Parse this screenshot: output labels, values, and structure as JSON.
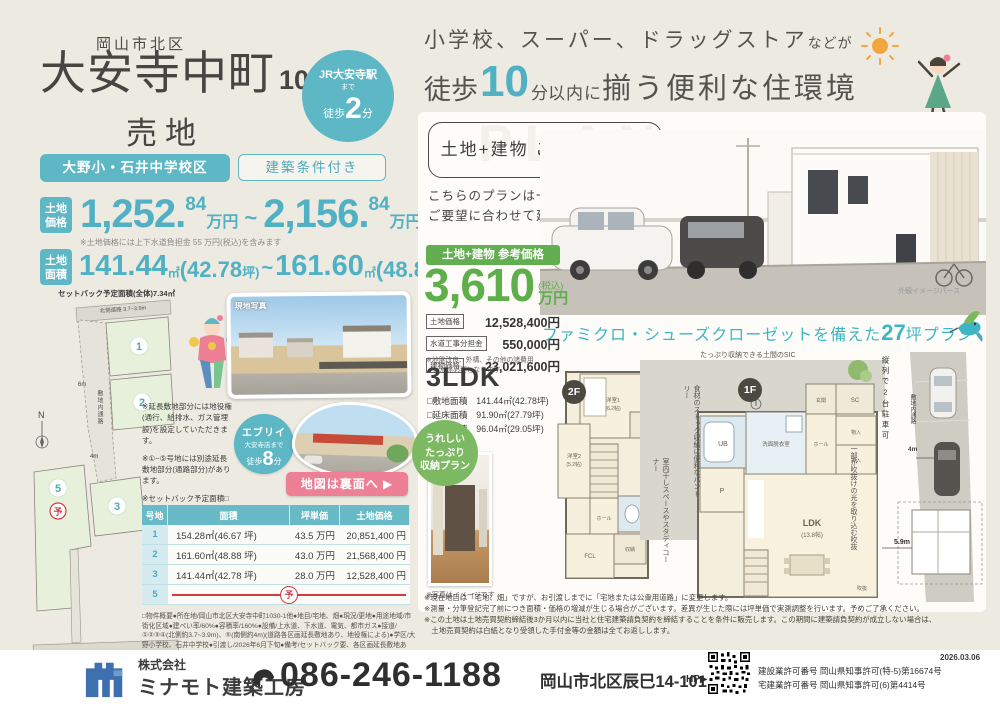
{
  "colors": {
    "teal": "#54b3c4",
    "green": "#5fae4c",
    "pink": "#ee8096",
    "red": "#d33b44",
    "blue": "#3e6fae"
  },
  "top": {
    "district": "岡山市北区",
    "title": "大安寺中町",
    "lot_no": "1030",
    "type": "売地",
    "station": {
      "l1": "JR大安寺駅",
      "l2": "まで",
      "walk": "徒歩",
      "min": "2",
      "unit": "分"
    },
    "badge_school": "大野小・石井中学校区",
    "badge_condition": "建築条件付き"
  },
  "price": {
    "label_l1": "土地",
    "label_l2": "価格",
    "n1": "1,252.",
    "d1": "84",
    "u1": "万円",
    "sep": "~",
    "n2": "2,156.",
    "d2": "84",
    "u2": "万円",
    "note": "※土地価格には上下水道負担金 55 万円(税込)を含みます",
    "area_label_l1": "土地",
    "area_label_l2": "面積",
    "a1": "141.44",
    "au1": "㎡",
    "ab1": "(42.78",
    "at1": "坪)",
    "asep": "~",
    "a2": "161.60",
    "au2": "㎡",
    "ab2": "(48.88",
    "at2": "坪)"
  },
  "siteplan": {
    "setback": "セットバック予定面積(全体)7.34㎡",
    "north_road": "北側道路 3.7~3.9m",
    "south_road": "南側道路 4.0m",
    "passage": "敷地内通路",
    "w6": "6m",
    "w4": "4m",
    "north": "N",
    "lot1": "1",
    "lot2": "2",
    "lot3": "3",
    "lot5": "5",
    "reserved": "予"
  },
  "site_photo_label": "現地写真",
  "notes": [
    "※延長敷地部分には地役権(通行、給排水、ガス管埋設)を設定していただきます。",
    "※①~⑤号地には別途延長敷地部分(通路部分)があります。",
    "※セットバック予定面積□は各号地の面積に含まれていません。"
  ],
  "every": {
    "name": "エブリイ",
    "sub": "大安寺店まで",
    "walk": "徒歩",
    "min": "8",
    "unit": "分"
  },
  "map_banner": "地図は裏面へ ▶",
  "lots_table": {
    "h": [
      "号地",
      "面積",
      "坪単価",
      "土地価格"
    ],
    "rows": [
      {
        "no": "1",
        "area": "154.28㎡(46.67 坪)",
        "tanka": "43.5 万円",
        "price": "20,851,400 円"
      },
      {
        "no": "2",
        "area": "161.60㎡(48.88 坪)",
        "tanka": "43.0 万円",
        "price": "21,568,400 円"
      },
      {
        "no": "3",
        "area": "141.44㎡(42.78 坪)",
        "tanka": "28.0 万円",
        "price": "12,528,400 円"
      },
      {
        "no": "5",
        "reserved": "予"
      }
    ]
  },
  "overview": "□物件概要●所在地/岡山市北区大安寺中町1030-1他●地目/宅地、畑●現況/更地●用途地域/市街化区域●建ぺい率/60%●容積率/160%●設備/上水道、下水道、電気、都市ガス●接道/①②③④(北側約3.7~3.9m)、⑤(南側約4m)(道路各区画延長敷地あり、地役権による)●学区/大野小学校、石井中学校●引渡し/2026年6月下旬●備考/セットバック要、各区画延長敷地あり、宅地造成等工事規制区域●取引態様/売主",
  "headline": {
    "l1a": "小学校、スーパー、ドラッグストア",
    "l1b": "などが",
    "l2a": "徒歩",
    "l2num": "10",
    "l2b": "分",
    "l2c": "以内に",
    "l2d": "揃う便利な住環境"
  },
  "plan": {
    "watermark": "PLAN",
    "box": "土地+建物 ご参考プラン",
    "lot_num": "3",
    "lot_suffix": "号地",
    "desc1": "こちらのプランは一例です。",
    "desc2": "ご要望に合わせて建物プランいたします。",
    "render_caption": "外観イメージパース",
    "price_badge": "土地+建物 参考価格",
    "price": "3,610",
    "tax": "(税込)",
    "unit": "万円",
    "breakdown": [
      {
        "label": "土地価格",
        "value": "12,528,400円"
      },
      {
        "label": "水道工事分担金",
        "value": "550,000円"
      },
      {
        "label": "建物価格",
        "value": "23,021,600円"
      }
    ],
    "bd_note1": "※地盤改良、外構、その他の諸費用",
    "bd_note2": "　が別途必要となります。",
    "tagline_a": "ファミクロ・シューズクローゼットを備えた",
    "tagline_num": "27",
    "tagline_b": "坪プラン"
  },
  "ldk": {
    "title": "3LDK",
    "specs": [
      "□敷地面積　141.44㎡(42.78坪)",
      "□延床面積　91.90㎡(27.79坪)",
      "□施工面積　96.04㎡(29.05坪)"
    ],
    "circle": [
      "うれしい",
      "たっぷり",
      "収納プラン"
    ],
    "photo_caption": "※写真はイメージです",
    "f2": "2F",
    "f1": "1F",
    "ann_sic": "たっぷり収納できる土間のSIC",
    "ann_pantry": "食材のストック収納に便利なパントリー",
    "ann_study": "室内干しスペースやスタディコーナー",
    "ann_void": "一部が吹抜けの光を取り込む吹抜",
    "ann_parking": "縦列で2台駐車可",
    "ann_passage": "敷地内通路",
    "ann_4m": "4m",
    "ann_59m": "5.9m",
    "rooms2f": {
      "r1": "洋室1",
      "r1s": "(6.2帖)",
      "r2": "洋室2",
      "r2s": "(5.2帖)",
      "hall": "ホール",
      "fcl": "FCL",
      "stor": "収納"
    },
    "rooms1f": {
      "ub": "UB",
      "wash": "洗面脱衣室",
      "hall": "ホール",
      "genkan": "玄関",
      "sc": "SC",
      "mono": "物入",
      "oshi": "押入",
      "p": "P",
      "ldk": "LDK",
      "ldks": "(13.8帖)",
      "void": "吹抜"
    }
  },
  "disclaimers": [
    "※現在地目は「宅地、畑」ですが、お引渡しまでに「宅地または公衆用道路」に変更します。",
    "※測量・分筆登記完了前につき面積・価格の増減が生じる場合がございます。差異が生じた際には坪単価で実測調整を行います。予めご了承ください。",
    "※この土地は土地売買契約締結後3か月以内に当社と住宅建築請負契約を締結することを条件に販売します。この期間に建築請負契約が成立しない場合は、",
    "　土地売買契約は白紙となり受領した手付金等の金額は全てお返しします。"
  ],
  "footer": {
    "company_prefix": "株式会社",
    "company": "ミナモト建築工房",
    "phone": "086-246-1188",
    "address": "岡山市北区辰巳14-101",
    "hp": "HP▶",
    "license1": "建設業許可番号 岡山県知事許可(特-5)第16674号",
    "license2": "宅建業許可番号 岡山県知事許可(6)第4414号",
    "date": "2026.03.06"
  }
}
